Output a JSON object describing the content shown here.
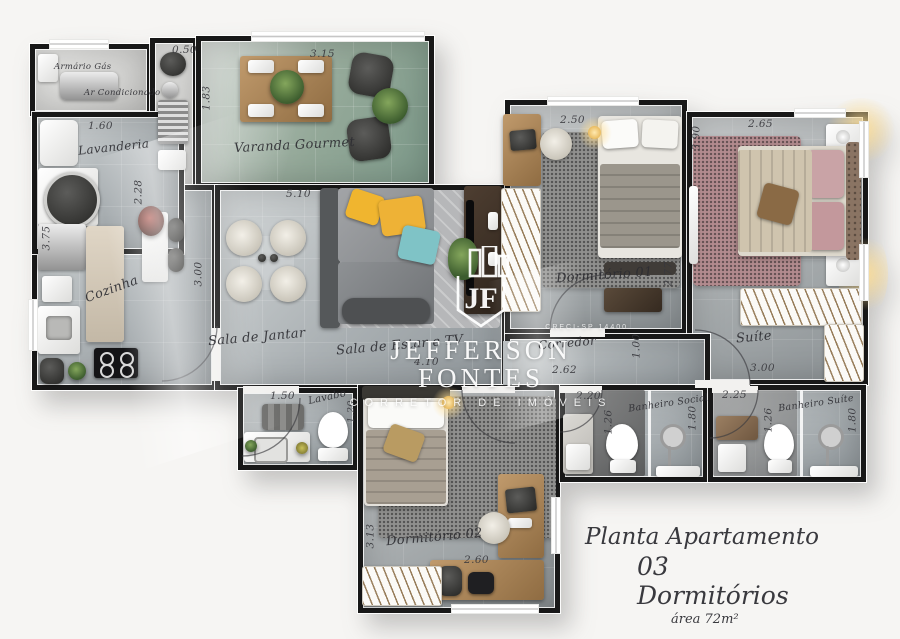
{
  "plan": {
    "rooms": {
      "armario_gas": "Armário Gás",
      "ar_condicionado": "Ar Condicionado",
      "lavanderia": "Lavanderia",
      "cozinha": "Cozinha",
      "varanda_gourmet": "Varanda Gourmet",
      "sala_jantar": "Sala de Jantar",
      "sala_estar": "Sala de Estar e TV",
      "dormitorio_01": "Dormitório 01",
      "corredor": "Corredor",
      "suite": "Suíte",
      "lavabo": "Lavabo",
      "dormitorio_02": "Dormitório 02",
      "banheiro_social": "Banheiro Social",
      "banheiro_suite": "Banheiro Suíte"
    },
    "dims": {
      "shaft_width": "0.50",
      "varanda_width": "3.15",
      "varanda_depth": "1.83",
      "lavanderia_width": "1.60",
      "lavanderia_depth": "2.28",
      "cozinha_depth": "3.75",
      "sala_width": "5.10",
      "sala_depth": "3.00",
      "sala_estar_width": "4.10",
      "dorm1_width": "2.50",
      "dorm1_depth": "2.77",
      "suite_width": "2.65",
      "suite_depth": "3.90",
      "suite_bottom": "3.00",
      "corredor_width": "2.62",
      "corredor_height": "1.00",
      "lavabo_width": "1.50",
      "lavabo_depth": "1.20",
      "dorm2_depth": "3.13",
      "dorm2_width": "2.60",
      "bsocial_width": "2.20",
      "bsocial_depth": "1.26",
      "bsocial_inner": "1.80",
      "bsuite_width": "2.25",
      "bsuite_depth": "1.26",
      "bsuite_inner": "1.80"
    }
  },
  "watermark": {
    "monogram": "JF",
    "creci": "CRECI-SP 14400",
    "brand": "JEFFERSON FONTES",
    "tagline": "CORRETOR DE IMÓVEIS"
  },
  "title_block": {
    "line1": "Planta Apartamento",
    "line2": "03 Dormitórios",
    "line3": "área 72m²"
  },
  "colors": {
    "wall": "#181818",
    "floor_light": "#d3d7d8",
    "floor_dark": "#8f969a",
    "varanda_green": "#7d9a8a",
    "accent_yellow": "#f0b52f",
    "accent_teal": "#7fc3c6",
    "rug_pink": "#b28b8e",
    "wood": "#b28a5e"
  }
}
